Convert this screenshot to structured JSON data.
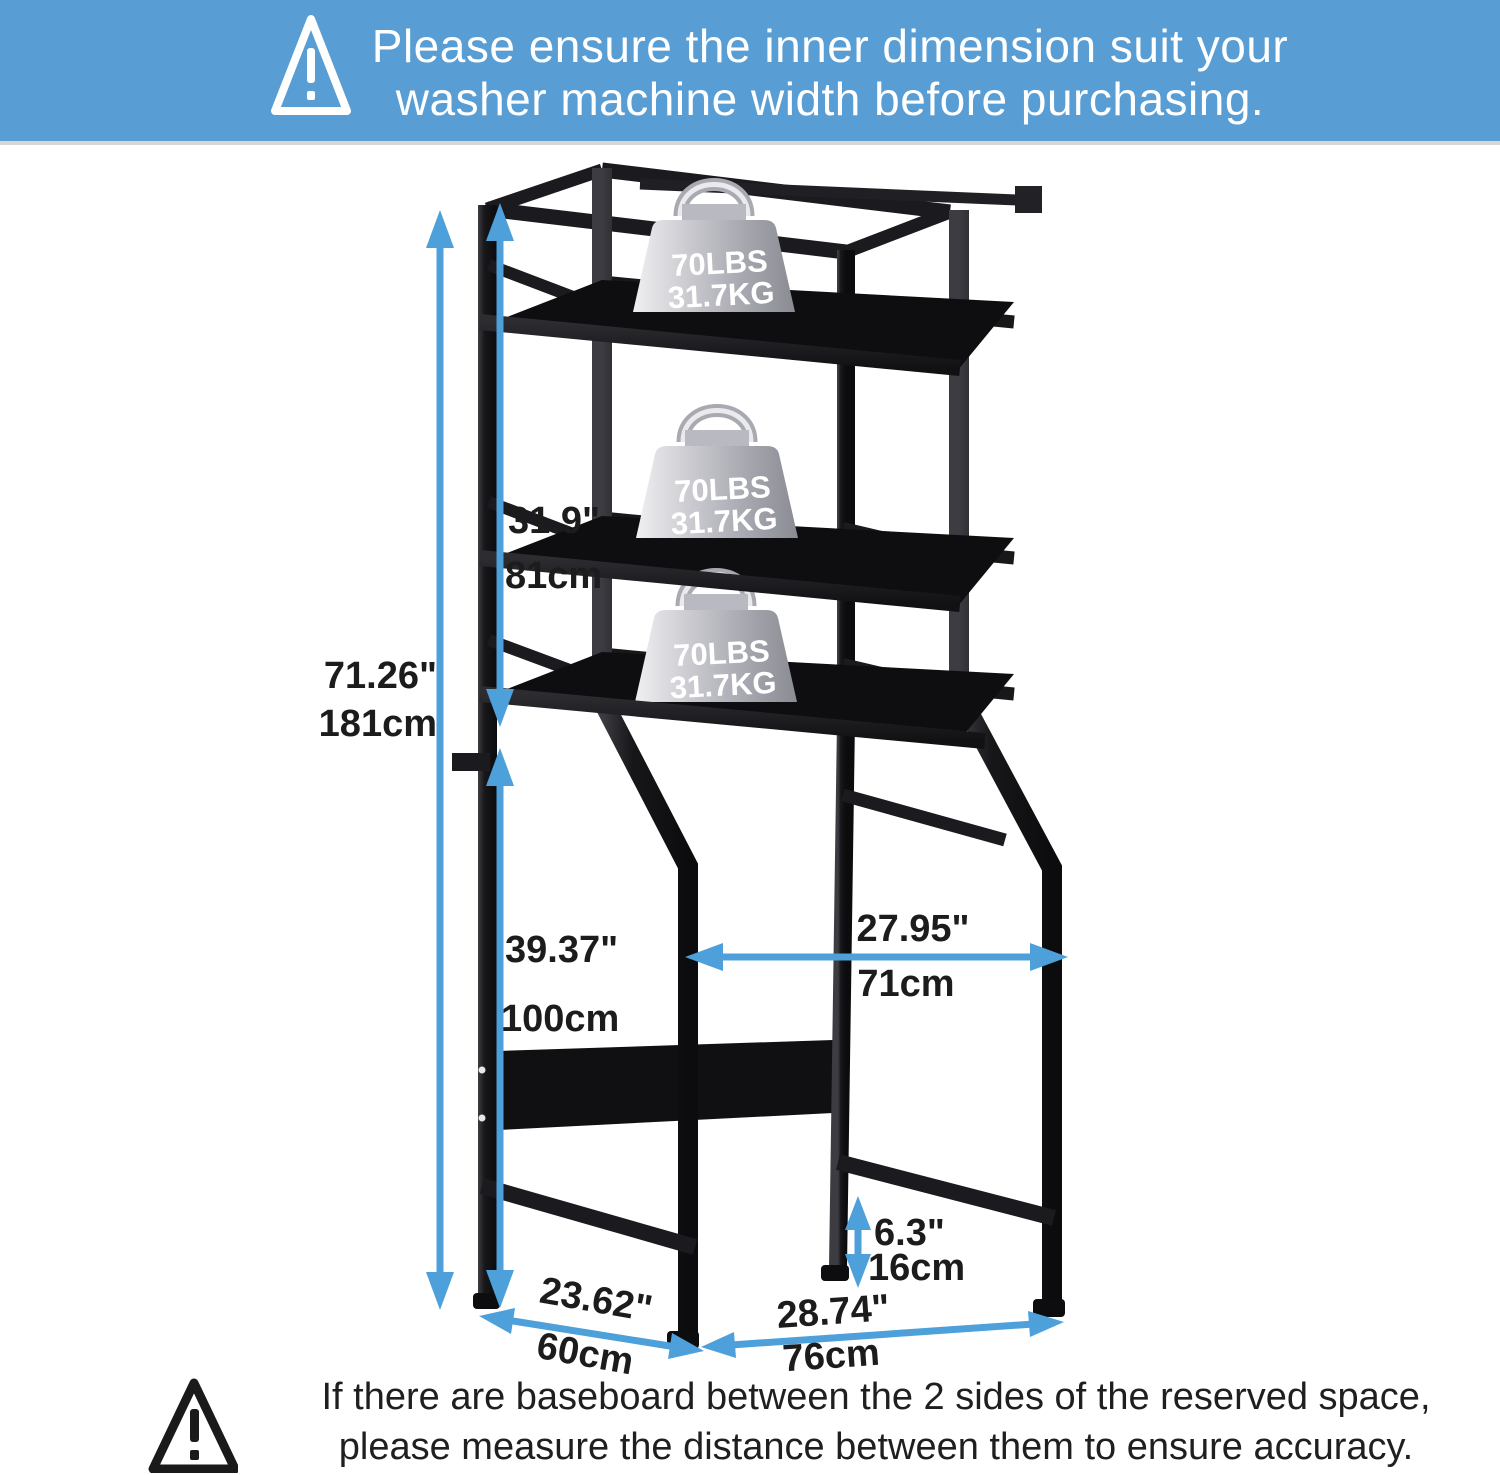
{
  "header": {
    "warning_icon": "exclamation-triangle",
    "line1": "Please ensure the inner dimension suit your",
    "line2": "washer machine width before purchasing."
  },
  "footer": {
    "warning_icon": "exclamation-triangle",
    "line1": "If there are baseboard between the 2 sides of the reserved space,",
    "line2": "please measure the distance between them to ensure accuracy."
  },
  "rack": {
    "description": "black over-washer storage rack with 3 shelves",
    "weights": [
      {
        "lbs": "70LBS",
        "kg": "31.7KG"
      },
      {
        "lbs": "70LBS",
        "kg": "31.7KG"
      },
      {
        "lbs": "70LBS",
        "kg": "31.7KG"
      }
    ]
  },
  "dimensions": {
    "total_height": {
      "inches": "71.26\"",
      "cm": "181cm"
    },
    "upper_height": {
      "inches": "31.9\"",
      "cm": "81cm"
    },
    "lower_height": {
      "inches": "39.37\"",
      "cm": "100cm"
    },
    "inner_width": {
      "inches": "27.95\"",
      "cm": "71cm"
    },
    "base_rail_height": {
      "inches": "6.3\"",
      "cm": "16cm"
    },
    "depth": {
      "inches": "23.62\"",
      "cm": "60cm"
    },
    "outer_width": {
      "inches": "28.74\"",
      "cm": "76cm"
    }
  },
  "colors": {
    "banner_blue": "#589dd3",
    "arrow_blue": "#4da0d9",
    "metal_black": "#1a1a1e",
    "weight_silver": "#c9c9cf"
  }
}
